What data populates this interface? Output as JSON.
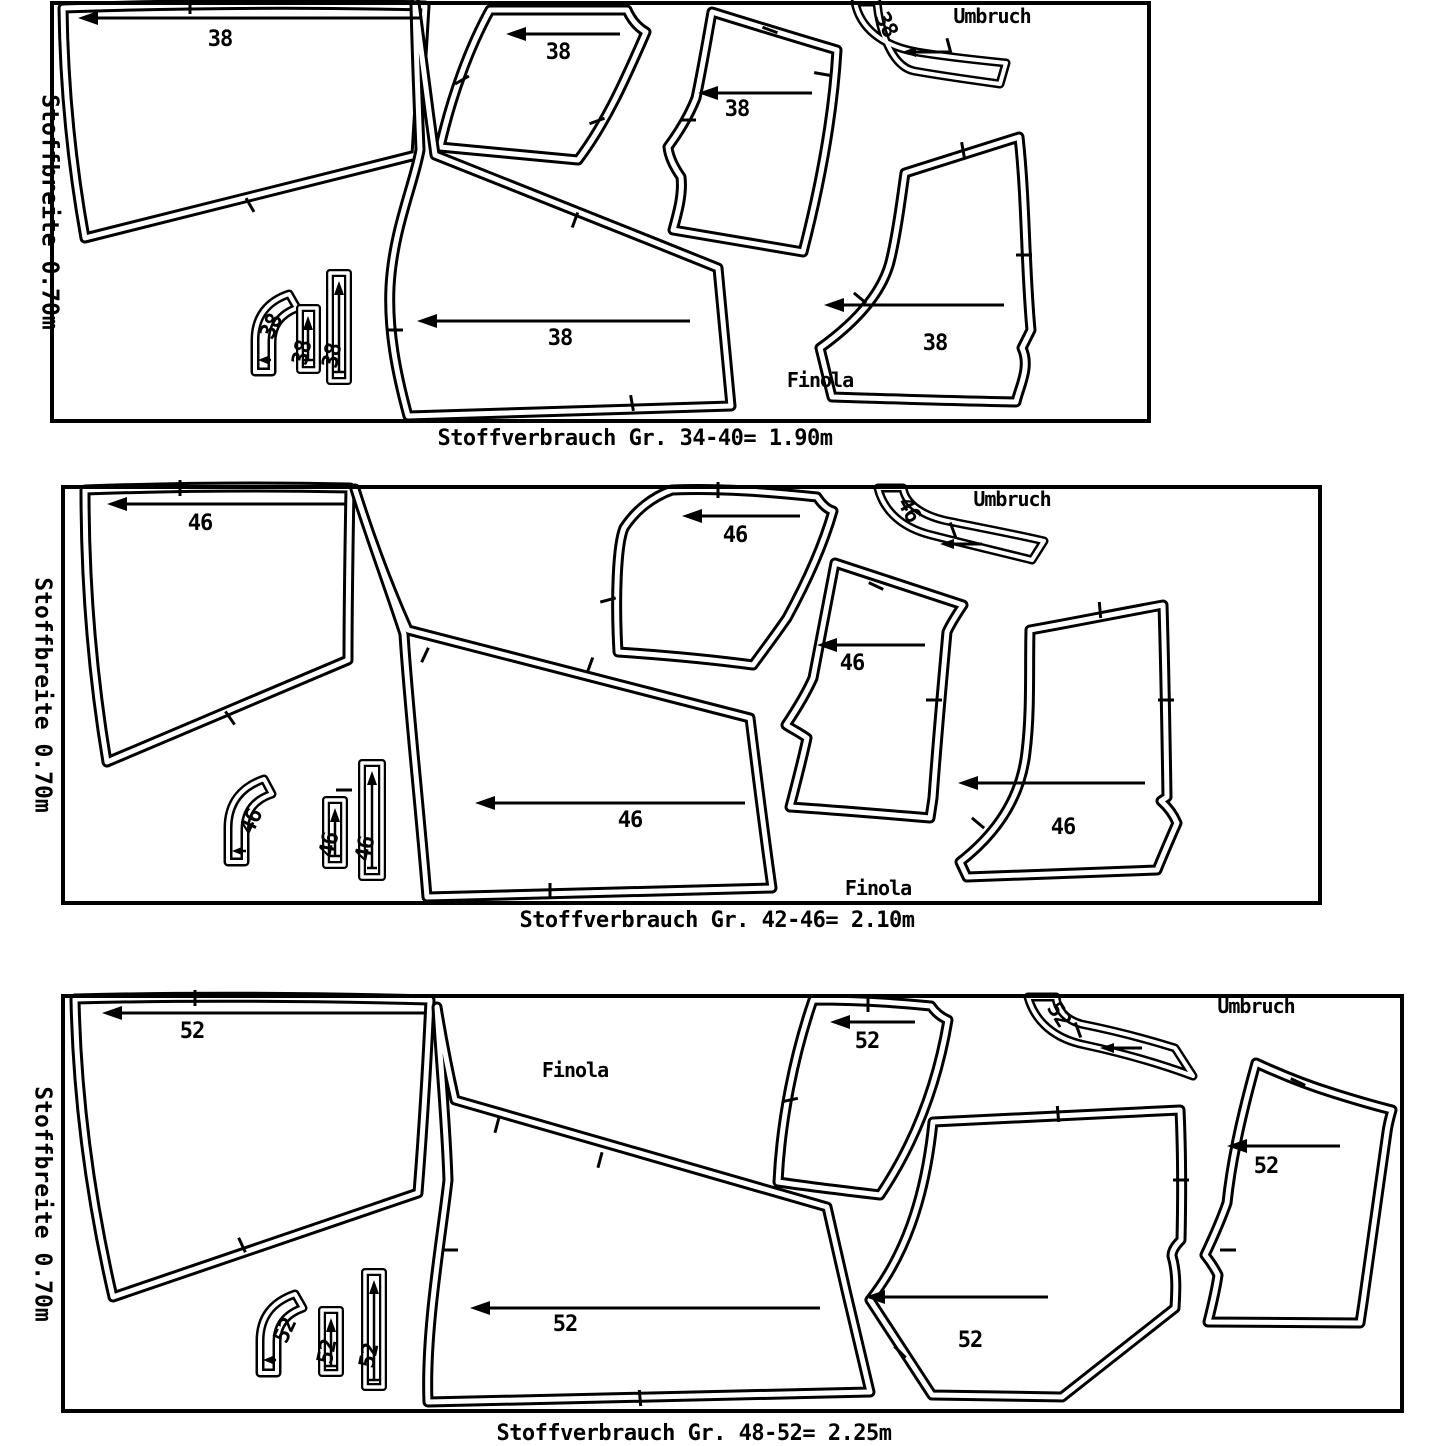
{
  "sheet": {
    "brand": "Finola",
    "type": "cutting-layout-diagram"
  },
  "panels": [
    {
      "size": "38",
      "fabric_width_label": "Stoffbreite 0.70m",
      "fold_label": "Umbruch",
      "brand_label": "Finola",
      "caption": "Stoffverbrauch Gr. 34-40= 1.90m",
      "size_labels": {
        "back": "38",
        "sleeve": "38",
        "side_panel": "38",
        "front": "38",
        "lower_front": "38",
        "neckband": "38",
        "facing": "38",
        "strip1": "38",
        "strip2": "38"
      }
    },
    {
      "size": "46",
      "fabric_width_label": "Stoffbreite 0.70m",
      "fold_label": "Umbruch",
      "brand_label": "Finola",
      "caption": "Stoffverbrauch Gr. 42-46= 2.10m",
      "size_labels": {
        "back": "46",
        "sleeve": "46",
        "side_panel": "46",
        "front": "46",
        "lower_front": "46",
        "neckband": "46",
        "facing": "46",
        "strip1": "46",
        "strip2": "46"
      }
    },
    {
      "size": "52",
      "fabric_width_label": "Stoffbreite 0.70m",
      "fold_label": "Umbruch",
      "brand_label": "Finola",
      "caption": "Stoffverbrauch Gr. 48-52= 2.25m",
      "size_labels": {
        "back": "52",
        "sleeve": "52",
        "side_panel": "52",
        "front": "52",
        "lower_front": "52",
        "neckband": "52",
        "facing": "52",
        "strip1": "52",
        "strip2": "52"
      }
    }
  ]
}
